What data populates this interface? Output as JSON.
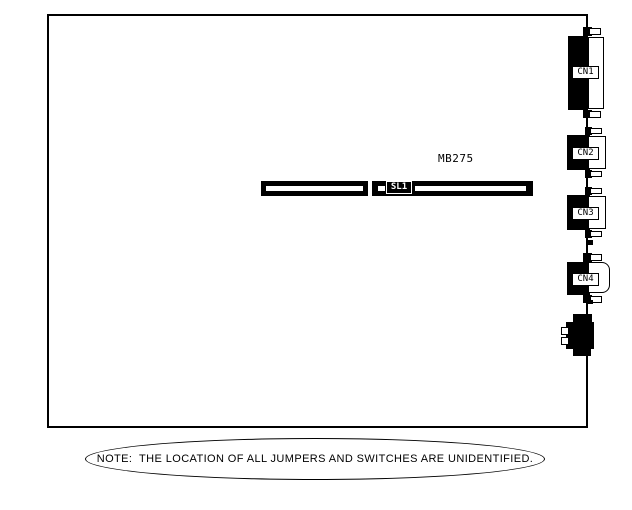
{
  "diagram": {
    "board_model": "MB275",
    "slot": {
      "label": "SL1"
    },
    "connectors": [
      {
        "label": "CN1"
      },
      {
        "label": "CN2"
      },
      {
        "label": "CN3"
      },
      {
        "label": "CN4"
      }
    ],
    "note": "NOTE:  THE LOCATION OF ALL JUMPERS AND SWITCHES ARE UNIDENTIFIED."
  }
}
